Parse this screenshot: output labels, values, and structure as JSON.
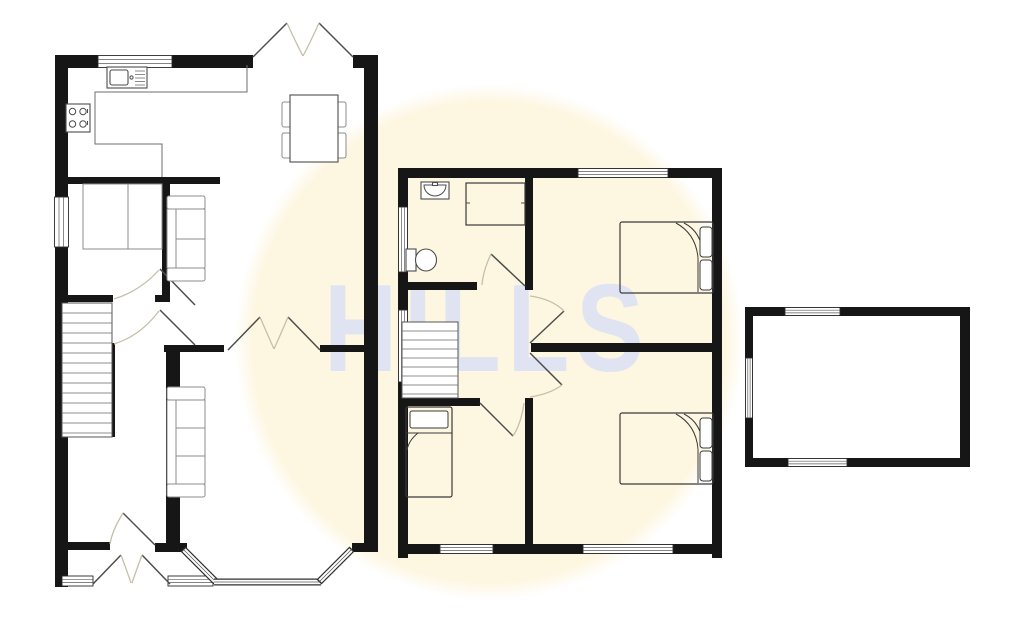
{
  "watermark": {
    "text": "HILLS"
  },
  "colors": {
    "background": "#ffffff",
    "highlight_circle": "#fdf6e1",
    "watermark": "#e0e4f2",
    "wall": "#161616",
    "line": "#6e6e6e",
    "furniture": "#8c8c8c",
    "fixture": "#4d4d4d",
    "door_leaf": "#4d4d4d",
    "door_arc": "#c6bfa8"
  },
  "plan": {
    "type": "2-storey house floor plan with detached garage",
    "ground_floor": {
      "rooms": [
        {
          "name": "kitchen-diner",
          "fixtures": [
            "sink-drainer-unit",
            "hob",
            "l-shaped-worktop",
            "dining-table",
            "four-chairs",
            "sofa",
            "french-doors-to-garden",
            "window"
          ]
        },
        {
          "name": "sitting-room",
          "fixtures": [
            "cupboard-unit",
            "side-window"
          ]
        },
        {
          "name": "hallway",
          "fixtures": [
            "staircase-up",
            "door-to-sitting-room",
            "door-to-front-room"
          ]
        },
        {
          "name": "front-room",
          "fixtures": [
            "sofa",
            "bay-window",
            "french-doors-to-diner"
          ]
        },
        {
          "name": "entrance-porch",
          "fixtures": [
            "double-entrance-doors",
            "two-front-windows",
            "inner-door"
          ]
        }
      ]
    },
    "first_floor": {
      "rooms": [
        {
          "name": "bathroom",
          "fixtures": [
            "wash-basin",
            "bath",
            "toilet",
            "side-window",
            "door"
          ]
        },
        {
          "name": "bedroom-1",
          "fixtures": [
            "double-bed",
            "rear-window",
            "door"
          ]
        },
        {
          "name": "bedroom-2",
          "fixtures": [
            "double-bed",
            "front-window",
            "door"
          ]
        },
        {
          "name": "bedroom-3",
          "fixtures": [
            "single-bed",
            "front-window",
            "door"
          ]
        },
        {
          "name": "landing",
          "fixtures": [
            "staircase-down",
            "side-window"
          ]
        }
      ]
    },
    "garage": {
      "rooms": [
        {
          "name": "garage",
          "fixtures": [
            "rear-window",
            "front-window",
            "side-door"
          ]
        }
      ]
    }
  }
}
